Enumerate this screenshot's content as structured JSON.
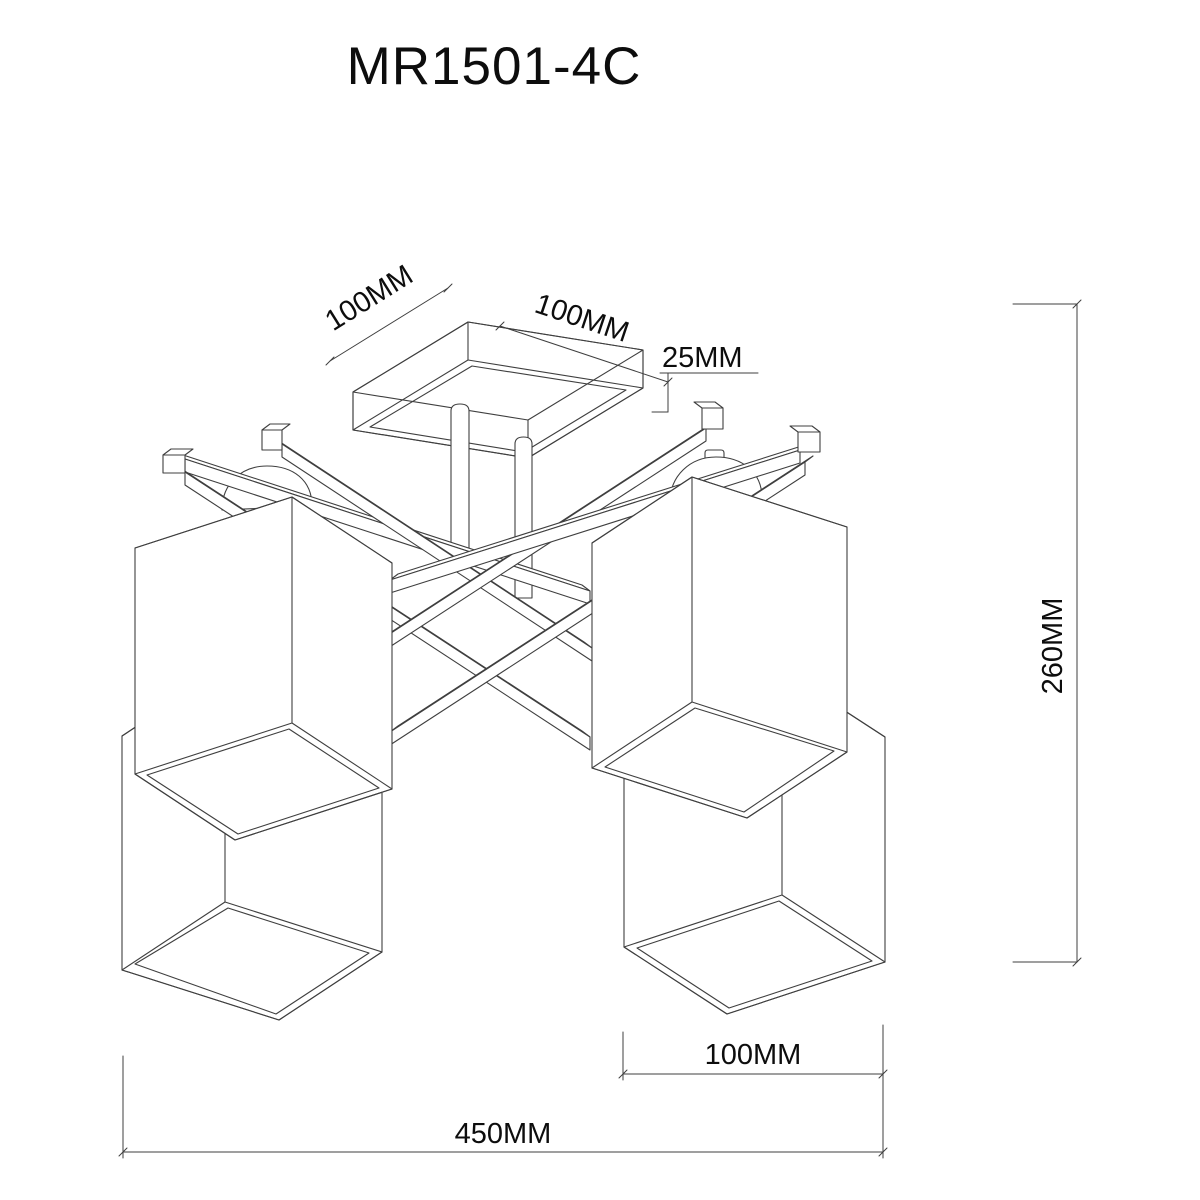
{
  "title": "MR1501-4C",
  "dimensions": {
    "canopy_edge_left": "100MM",
    "canopy_edge_right": "100MM",
    "canopy_height": "25MM",
    "fixture_height": "260MM",
    "shade_width": "100MM",
    "fixture_width": "450MM"
  },
  "colors": {
    "background": "#ffffff",
    "line": "#3f3f3f",
    "text": "#0d0d0d"
  }
}
